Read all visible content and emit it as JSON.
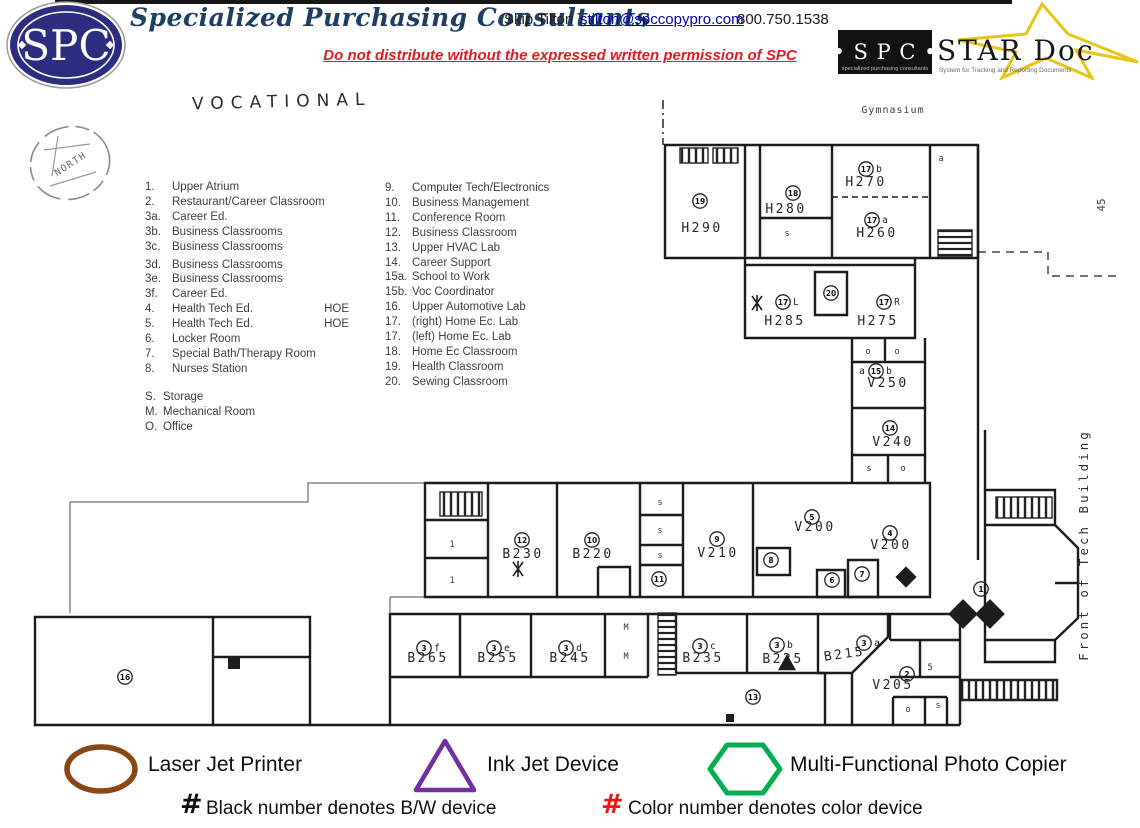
{
  "header": {
    "logo_text": "SPC",
    "company": "Specialized Purchasing Consultants",
    "contact_name": "Skip Tilton",
    "contact_email": "stilton@spccopypro.com",
    "contact_phone": "800.750.1538",
    "notice": "Do not distribute without the expressed written permission of SPC",
    "star_logo": {
      "spc": "• S P C •",
      "spc_sub": "specialized purchasing consultants",
      "name": "STAR Doc",
      "tagline": "System for Tracking and Reporting Documents"
    },
    "colors": {
      "navy": "#2d2d80",
      "title_blue": "#1e3e63",
      "alert_red": "#e01b28",
      "link_blue": "#0000bb",
      "star_gold": "#e8c614"
    }
  },
  "plan": {
    "title": "VOCATIONAL",
    "compass": "NORTH",
    "gym": "Gymnasium",
    "front": "Front of Tech Building",
    "side_note": "45",
    "key_left": [
      {
        "n": "1.",
        "l": "Upper Atrium"
      },
      {
        "n": "2.",
        "l": "Restaurant/Career Classroom"
      },
      {
        "n": "3a.",
        "l": "Career Ed."
      },
      {
        "n": "3b.",
        "l": "Business Classrooms"
      },
      {
        "n": "3c.",
        "l": "Business Classrooms"
      },
      {
        "n": "3d.",
        "l": "Business Classrooms"
      },
      {
        "n": "3e.",
        "l": "Business Classrooms"
      },
      {
        "n": "3f.",
        "l": "Career Ed."
      },
      {
        "n": "4.",
        "l": "Health Tech Ed.",
        "e": "HOE"
      },
      {
        "n": "5.",
        "l": "Health Tech Ed.",
        "e": "HOE"
      },
      {
        "n": "6.",
        "l": "Locker Room"
      },
      {
        "n": "7.",
        "l": "Special Bath/Therapy Room"
      },
      {
        "n": "8.",
        "l": "Nurses Station"
      }
    ],
    "key_misc": [
      {
        "n": "S.",
        "l": "Storage"
      },
      {
        "n": "M.",
        "l": "Mechanical Room"
      },
      {
        "n": "O.",
        "l": "Office"
      }
    ],
    "key_right": [
      {
        "n": "9.",
        "l": "Computer Tech/Electronics"
      },
      {
        "n": "10.",
        "l": "Business Management"
      },
      {
        "n": "11.",
        "l": "Conference Room"
      },
      {
        "n": "12.",
        "l": "Business Classroom"
      },
      {
        "n": "13.",
        "l": "Upper HVAC Lab"
      },
      {
        "n": "14.",
        "l": "Career Support"
      },
      {
        "n": "15a.",
        "l": "School to Work"
      },
      {
        "n": "15b.",
        "l": "Voc Coordinator"
      },
      {
        "n": "16.",
        "l": "Upper Automotive Lab"
      },
      {
        "n": "17.",
        "l": "(right) Home Ec. Lab"
      },
      {
        "n": "17.",
        "l": "(left) Home Ec. Lab"
      },
      {
        "n": "18.",
        "l": "Home Ec Classroom"
      },
      {
        "n": "19.",
        "l": "Health Classroom"
      },
      {
        "n": "20.",
        "l": "Sewing Classroom"
      }
    ],
    "rooms": [
      {
        "t": "H290",
        "x": 702,
        "y": 232
      },
      {
        "t": "H280",
        "x": 786,
        "y": 213
      },
      {
        "t": "H270",
        "x": 866,
        "y": 186
      },
      {
        "t": "H260",
        "x": 877,
        "y": 237
      },
      {
        "t": "H285",
        "x": 785,
        "y": 325
      },
      {
        "t": "H275",
        "x": 878,
        "y": 325
      },
      {
        "t": "V250",
        "x": 888,
        "y": 387
      },
      {
        "t": "V240",
        "x": 893,
        "y": 446
      },
      {
        "t": "V200",
        "x": 815,
        "y": 531
      },
      {
        "t": "V200",
        "x": 891,
        "y": 549
      },
      {
        "t": "V210",
        "x": 718,
        "y": 557
      },
      {
        "t": "B230",
        "x": 523,
        "y": 558
      },
      {
        "t": "B220",
        "x": 593,
        "y": 558
      },
      {
        "t": "B265",
        "x": 428,
        "y": 662
      },
      {
        "t": "B255",
        "x": 498,
        "y": 662
      },
      {
        "t": "B245",
        "x": 570,
        "y": 662
      },
      {
        "t": "B235",
        "x": 703,
        "y": 662
      },
      {
        "t": "B225",
        "x": 783,
        "y": 663
      },
      {
        "t": "B215",
        "x": 845,
        "y": 658,
        "r": -8
      },
      {
        "t": "V205",
        "x": 893,
        "y": 689
      }
    ],
    "markers": [
      {
        "n": "19",
        "x": 700,
        "y": 201
      },
      {
        "n": "18",
        "x": 793,
        "y": 193
      },
      {
        "n": "17",
        "x": 866,
        "y": 169,
        "s": "b"
      },
      {
        "n": "17",
        "x": 872,
        "y": 220,
        "s": "a"
      },
      {
        "n": "17",
        "x": 783,
        "y": 302,
        "s": "L"
      },
      {
        "n": "17",
        "x": 884,
        "y": 302,
        "s": "R"
      },
      {
        "n": "20",
        "x": 831,
        "y": 293
      },
      {
        "n": "15",
        "x": 876,
        "y": 371,
        "p": "a",
        "s": "b"
      },
      {
        "n": "14",
        "x": 890,
        "y": 428
      },
      {
        "n": "12",
        "x": 522,
        "y": 540
      },
      {
        "n": "10",
        "x": 592,
        "y": 540
      },
      {
        "n": "11",
        "x": 659,
        "y": 579
      },
      {
        "n": "9",
        "x": 717,
        "y": 539
      },
      {
        "n": "5",
        "x": 812,
        "y": 517
      },
      {
        "n": "8",
        "x": 771,
        "y": 560
      },
      {
        "n": "6",
        "x": 832,
        "y": 580
      },
      {
        "n": "7",
        "x": 862,
        "y": 574
      },
      {
        "n": "4",
        "x": 890,
        "y": 533
      },
      {
        "n": "1",
        "x": 981,
        "y": 589
      },
      {
        "n": "3",
        "x": 424,
        "y": 648,
        "s": "f"
      },
      {
        "n": "3",
        "x": 494,
        "y": 648,
        "s": "e"
      },
      {
        "n": "3",
        "x": 566,
        "y": 648,
        "s": "d"
      },
      {
        "n": "3",
        "x": 700,
        "y": 646,
        "s": "c"
      },
      {
        "n": "3",
        "x": 777,
        "y": 645,
        "s": "b"
      },
      {
        "n": "3",
        "x": 864,
        "y": 643,
        "s": "a"
      },
      {
        "n": "2",
        "x": 907,
        "y": 674
      },
      {
        "n": "16",
        "x": 125,
        "y": 677
      },
      {
        "n": "13",
        "x": 753,
        "y": 697
      }
    ],
    "labels": [
      {
        "t": "a",
        "x": 941,
        "y": 161
      },
      {
        "t": "s",
        "x": 787,
        "y": 236
      },
      {
        "t": "o",
        "x": 868,
        "y": 354
      },
      {
        "t": "o",
        "x": 897,
        "y": 354
      },
      {
        "t": "s",
        "x": 869,
        "y": 471
      },
      {
        "t": "o",
        "x": 903,
        "y": 471
      },
      {
        "t": "1",
        "x": 452,
        "y": 547
      },
      {
        "t": "1",
        "x": 452,
        "y": 583
      },
      {
        "t": "s",
        "x": 660,
        "y": 505
      },
      {
        "t": "s",
        "x": 660,
        "y": 533
      },
      {
        "t": "s",
        "x": 660,
        "y": 558
      },
      {
        "t": "M",
        "x": 626,
        "y": 630
      },
      {
        "t": "M",
        "x": 626,
        "y": 659
      },
      {
        "t": "5",
        "x": 930,
        "y": 670
      },
      {
        "t": "s",
        "x": 938,
        "y": 708
      },
      {
        "t": "o",
        "x": 908,
        "y": 712
      }
    ],
    "devices": [
      {
        "k": "x",
        "x": 757,
        "y": 303
      },
      {
        "k": "x",
        "x": 518,
        "y": 569
      },
      {
        "k": "diamond",
        "x": 906,
        "y": 577,
        "s": 15
      },
      {
        "k": "diamond",
        "x": 963,
        "y": 614,
        "s": 21
      },
      {
        "k": "diamond",
        "x": 990,
        "y": 614,
        "s": 21
      },
      {
        "k": "square",
        "x": 234,
        "y": 663,
        "s": 12
      },
      {
        "k": "square",
        "x": 730,
        "y": 718,
        "s": 8
      },
      {
        "k": "triangle",
        "x": 787,
        "y": 663,
        "s": 9
      }
    ]
  },
  "legend": {
    "laser": "Laser Jet Printer",
    "inkjet": "Ink Jet Device",
    "copier": "Multi-Functional Photo Copier",
    "hash": "#",
    "bw_note": "Black number denotes B/W device",
    "color_note": "Color number denotes color device",
    "colors": {
      "laser": "#8a4716",
      "inkjet": "#7030a0",
      "copier": "#00b050",
      "color_hash": "#ee1111"
    }
  }
}
